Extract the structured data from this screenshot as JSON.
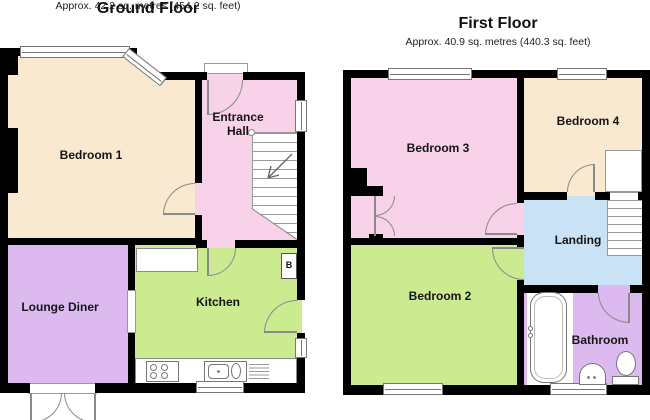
{
  "ground_floor": {
    "title": "Ground Floor",
    "area": "Approx. 42.2 sq. metres (454.2 sq. feet)",
    "rooms": {
      "bedroom1": "Bedroom 1",
      "entrance_hall": "Entrance Hall",
      "lounge_diner": "Lounge Diner",
      "kitchen": "Kitchen",
      "boiler": "B"
    }
  },
  "first_floor": {
    "title": "First Floor",
    "area": "Approx. 40.9 sq. metres (440.3 sq. feet)",
    "rooms": {
      "bedroom3": "Bedroom 3",
      "bedroom4": "Bedroom 4",
      "landing": "Landing",
      "bedroom2": "Bedroom 2",
      "bathroom": "Bathroom"
    }
  },
  "colors": {
    "wall": "#000000",
    "cream": "#F8E9D0",
    "pink": "#F8D2E8",
    "lavender": "#DCBAF0",
    "green": "#CCEA90",
    "blue": "#C9E2F6",
    "line": "#8a8a8a"
  }
}
